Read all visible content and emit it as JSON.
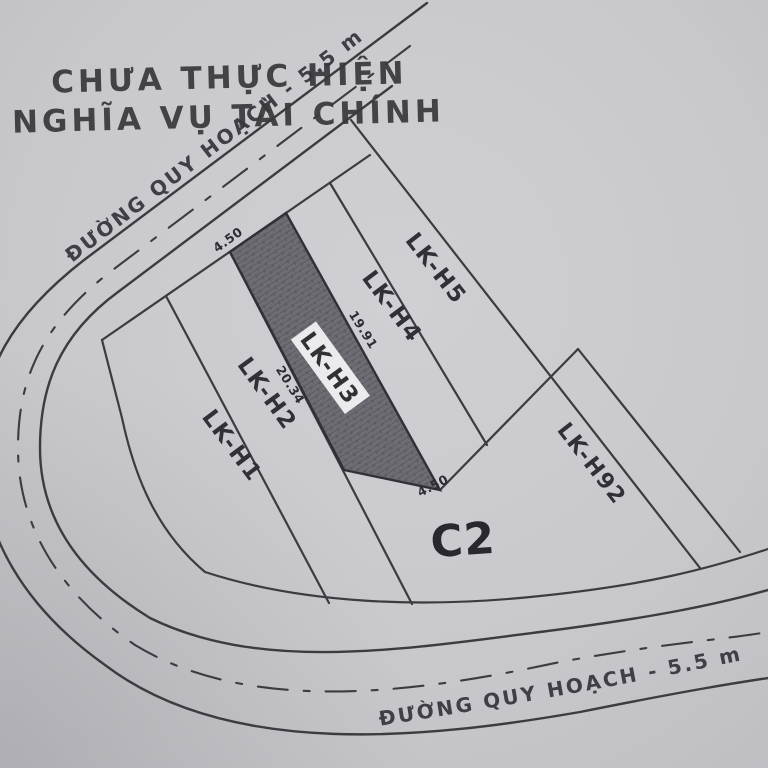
{
  "document": {
    "type": "cadastral-plan-scan",
    "stamp": {
      "line1": "CHƯA THỰC HIỆN",
      "line2": "NGHĨA VỤ TÀI CHÍNH"
    },
    "roads": {
      "top_road_label": "ĐƯỜNG QUY HOẠCH - 5.5 m",
      "bottom_road_label": "ĐƯỜNG QUY HOẠCH - 5.5 m",
      "width_note": "5.5 m"
    },
    "plots": {
      "h1": "LK-H1",
      "h2": "LK-H2",
      "h3": "LK-H3",
      "h4": "LK-H4",
      "h5": "LK-H5",
      "h92": "LK-H92",
      "c2": "C2",
      "highlighted_plot": "LK-H3"
    },
    "dimensions": {
      "frontage_top": "4.50",
      "frontage_bottom": "4.50",
      "depth_left": "20.34",
      "depth_right": "19.91"
    },
    "colors": {
      "paper": "#c9c9cd",
      "line": "#3b3b40",
      "highlight_fill": "#6c6c72",
      "stamp_ink": "#39383c",
      "label_box": "#ebebee"
    }
  }
}
